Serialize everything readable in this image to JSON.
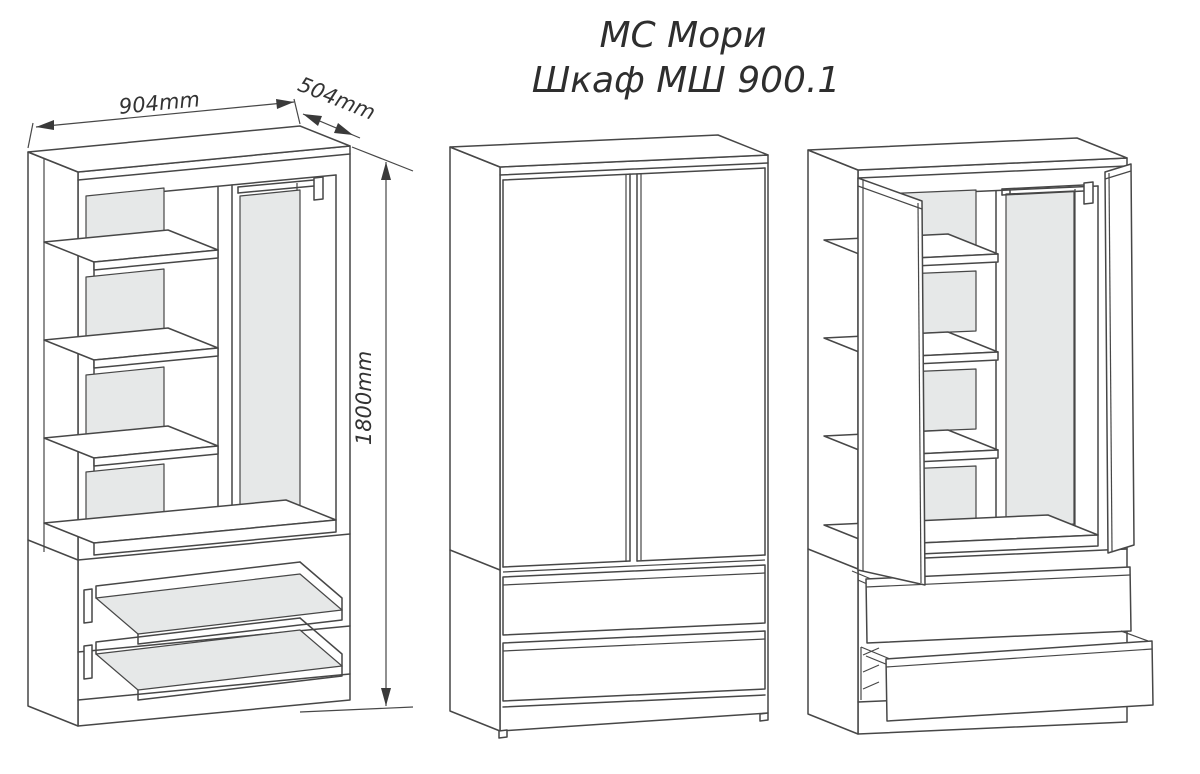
{
  "title": {
    "line1": "МС Мори",
    "line2": "Шкаф МШ 900.1"
  },
  "dimensions": {
    "width_label": "904mm",
    "depth_label": "504mm",
    "height_label": "1800mm"
  },
  "colors": {
    "line": "#474747",
    "back_panel_fill": "#e6e8e8",
    "surface": "#ffffff",
    "text": "#2e2e2e"
  }
}
